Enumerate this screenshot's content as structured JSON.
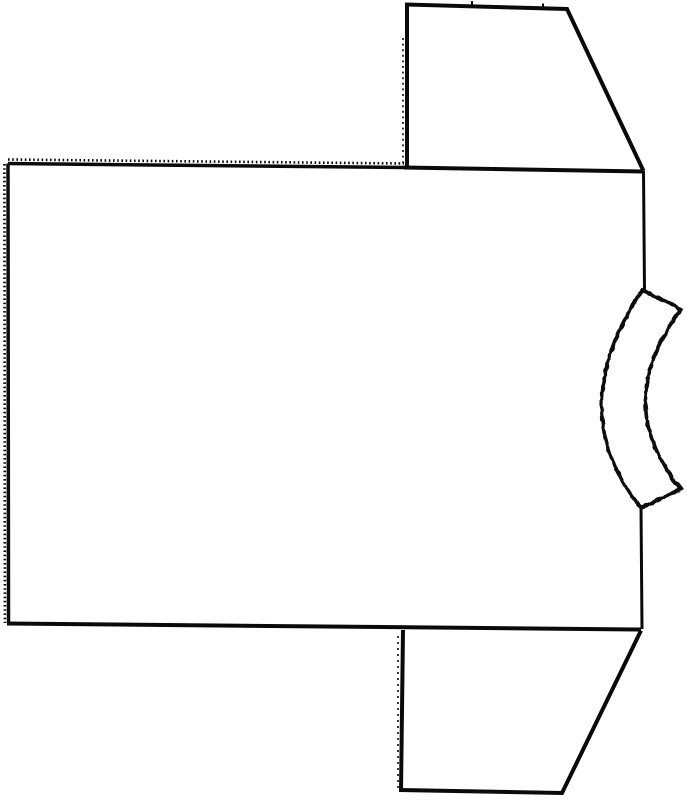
{
  "canvas": {
    "width": 687,
    "height": 800,
    "background": "#ffffff",
    "ink": "#0a0a0a"
  },
  "drawing": {
    "label": "Hand-drawn flat line drawing of a T-shirt sewing pattern shown rotated sideways: large rectangular body panel with pinked (serrated) top and left edges, two trapezoid sleeves extending from the right side, and a curved ribbed neckband strip on the middle right edge",
    "shapes": [
      {
        "name": "body-top-edge",
        "d": "M 8,163.5 L 404,167.5",
        "w": 3.5
      },
      {
        "name": "body-top-edge-pinking",
        "d": "M 8,159.5 L 404,163.5",
        "w": 2.6,
        "dash": "1.6,2.6"
      },
      {
        "name": "body-left-edge",
        "d": "M 8,163.5 L 8.5,623",
        "w": 3.5
      },
      {
        "name": "body-left-edge-pinking",
        "d": "M 4.4,164 L 4.9,623",
        "w": 2.6,
        "dash": "1.6,2.6"
      },
      {
        "name": "body-bottom-edge",
        "d": "M 7,623.5 L 641,629.5",
        "w": 4
      },
      {
        "name": "shoulder-seam",
        "d": "M 404,167.5 L 643,171.5",
        "w": 4
      },
      {
        "name": "body-right-edge-upper",
        "d": "M 643.5,171 L 644.5,290",
        "w": 3
      },
      {
        "name": "body-right-edge-lower",
        "d": "M 641,506 L 642,629",
        "w": 3
      },
      {
        "name": "top-sleeve-outline",
        "d": "M 407,166.5 L 407,4.5 L 567,9 L 643.5,171",
        "w": 4
      },
      {
        "name": "top-sleeve-fold-line",
        "d": "M 403,38 L 403,164",
        "w": 1.6,
        "dash": "2,3.6"
      },
      {
        "name": "top-sleeve-notch-1",
        "d": "M 472,1 L 472,6.5",
        "w": 2
      },
      {
        "name": "top-sleeve-notch-2",
        "d": "M 543,3.5 L 543,9",
        "w": 2
      },
      {
        "name": "bottom-sleeve-outline",
        "d": "M 403,630 L 401,790 L 562,793 L 641,630.5",
        "w": 4
      },
      {
        "name": "bottom-sleeve-fold-line",
        "d": "M 398,636 L 398,788",
        "w": 1.6,
        "dash": "2,4"
      },
      {
        "name": "neckband-strip",
        "d": "M 642,290 L 681,309 Q 610,404 681,489 L 641,508 Q 562,411 642,290 Z",
        "w": 3.6,
        "fill": "#ffffff",
        "rough": true
      }
    ]
  }
}
